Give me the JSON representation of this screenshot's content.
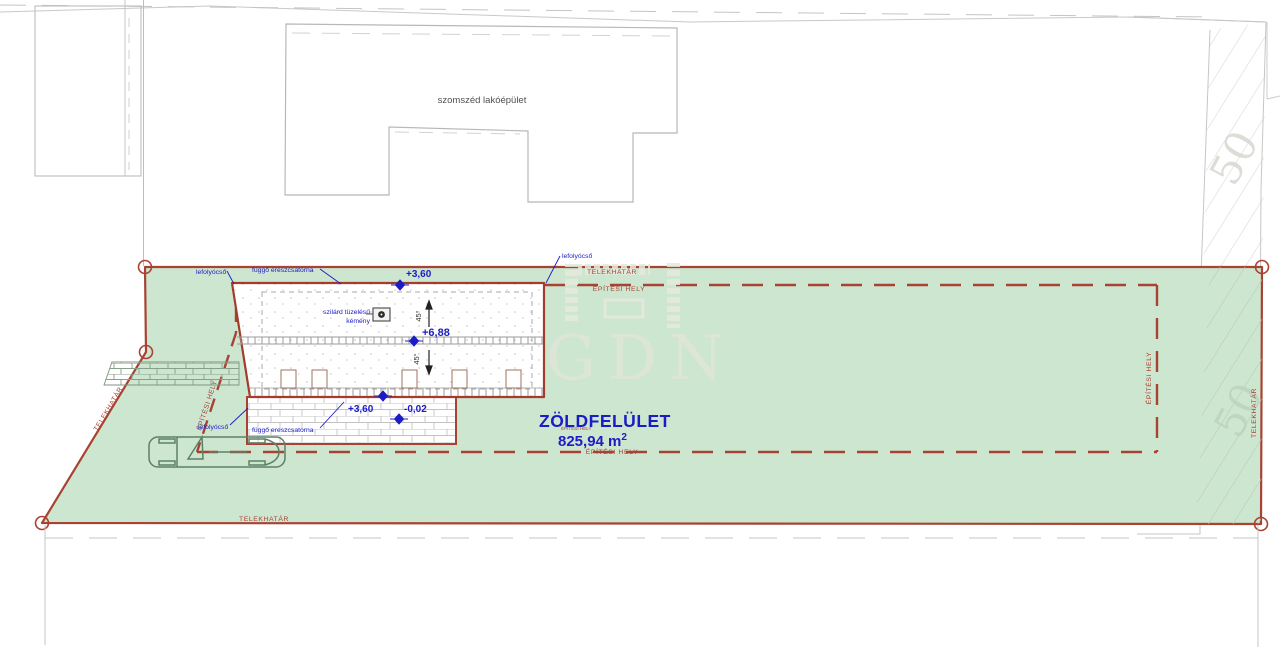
{
  "plan": {
    "neighbor_building_label": "szomszéd lakóépület",
    "boundary_label": "TELEKHATÁR",
    "building_zone_label": "ÉPÍTÉSI HELY",
    "downpipe_label": "lefolyócső",
    "gutter_label": "függő ereszcsatorna",
    "chimney_label_line1": "szilárd tüzelésű",
    "chimney_label_line2": "kémény",
    "green_area": {
      "title": "ZÖLDFELÜLET",
      "value": "825,94 m",
      "sup": "2"
    },
    "elevations": {
      "eave": "+3,60",
      "ridge": "+6,88",
      "terrace": "+3,60",
      "ground": "-0,02"
    },
    "roof_pitch": "45°",
    "road_number": "50",
    "watermark_text": "GDN",
    "colors": {
      "boundary_red": "#a84334",
      "annotation_blue": "#1c1cc4",
      "plot_green": "#cde6d0",
      "neighbor_gray": "#b8b8b8",
      "watermark_cream": "#e3e6d9"
    }
  }
}
